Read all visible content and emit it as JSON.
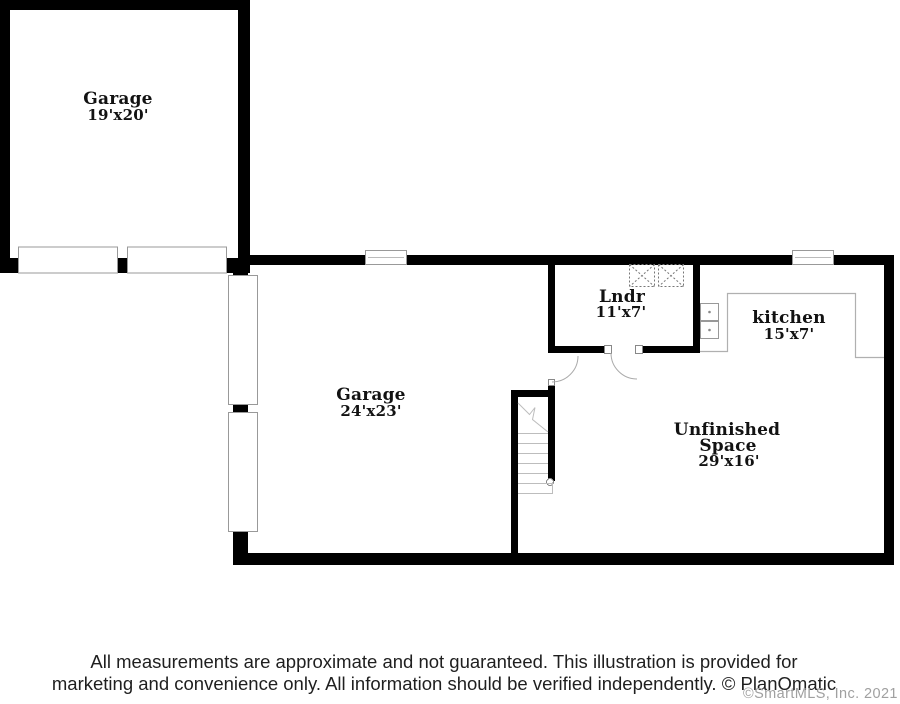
{
  "meta": {
    "type": "floor-plan",
    "width_px": 900,
    "height_px": 704
  },
  "rooms": {
    "garage_upper": {
      "name": "Garage",
      "dims": "19'x20'"
    },
    "garage_lower": {
      "name": "Garage",
      "dims": "24'x23'"
    },
    "laundry": {
      "name": "Lndr",
      "dims": "11'x7'"
    },
    "kitchen": {
      "name": "kitchen",
      "dims": "15'x7'"
    },
    "unfinished": {
      "name_line1": "Unfinished",
      "name_line2": "Space",
      "dims": "29'x16'"
    }
  },
  "icons": {
    "washer_dryer": "dashed-x-square-icon",
    "sink": "double-sink-icon",
    "window": "window-symbol-icon",
    "garage_door": "garage-door-panel-icon",
    "door": "door-swing-arc-icon",
    "stairs": "staircase-treads-icon"
  },
  "footer": {
    "disclaimer_line1": "All measurements are approximate and not guaranteed. This illustration is provided for",
    "disclaimer_line2": "marketing and convenience only. All information should be verified independently. © PlanOmatic",
    "mls_copyright": "©SmartMLS, Inc. 2021"
  },
  "colors": {
    "background": "#ffffff",
    "wall": "#000000",
    "fixture_stroke": "#999999",
    "counter_stroke": "#b0b0b0",
    "stair_tread": "#bdbdbd",
    "appliance_dash": "#777777",
    "label_text": "#121212",
    "disclaimer_text": "#1f1f1f",
    "mls_text": "#a0a0a0"
  }
}
